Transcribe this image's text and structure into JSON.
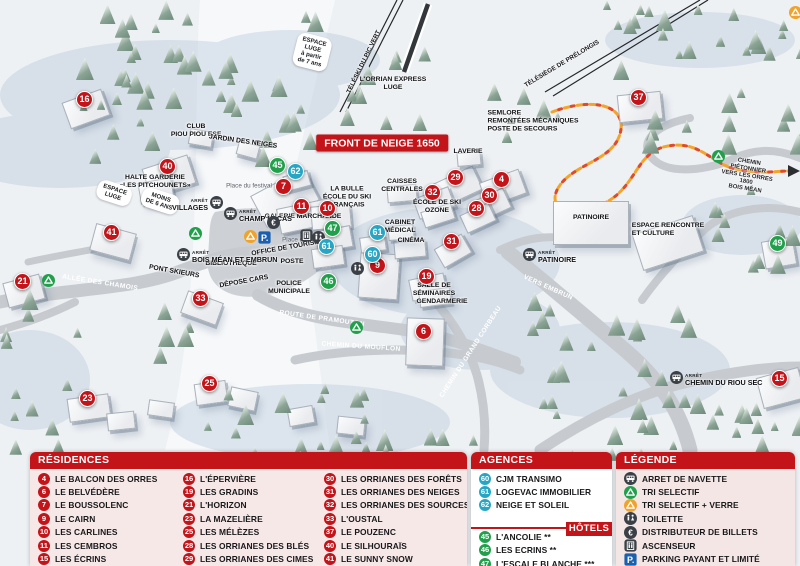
{
  "colors": {
    "red": "#c3141a",
    "teal": "#27a5c5",
    "green": "#21a04c",
    "orange": "#f0a22a",
    "busdark": "#3a4046",
    "parkblue": "#1b5fae",
    "panelpink": "#f7e8e8"
  },
  "map": {
    "bus_stop_word": "ARRÊT",
    "labels": [
      {
        "t": "FRONT DE NEIGE 1650",
        "cls": "banner",
        "x": 382,
        "y": 143
      },
      {
        "t": "ESPACE\nLUGE\nà partir\nde 7 ans",
        "cls": "pill",
        "x": 312,
        "y": 52,
        "rot": 14
      },
      {
        "t": "TÉLÉSKI DU PIC VERT",
        "cls": "lift",
        "x": 364,
        "y": 62,
        "rot": -64
      },
      {
        "t": "L'ORRIAN EXPRESS\nLUGE",
        "cls": "place",
        "x": 393,
        "y": 84
      },
      {
        "t": "TÉLÉSIÈGE DE PRÉLONGIS",
        "cls": "lift",
        "x": 562,
        "y": 64,
        "rot": -31
      },
      {
        "t": "SEMLORE\nREMONTÉES MÉCANIQUES\nPOSTE DE SECOURS",
        "cls": "place-left",
        "x": 533,
        "y": 121
      },
      {
        "t": "CLUB\nPIOU PIOU ESF",
        "cls": "place",
        "x": 196,
        "y": 131
      },
      {
        "t": "JARDIN DES NEIGES",
        "cls": "place",
        "x": 243,
        "y": 142,
        "rot": 8
      },
      {
        "t": "HALTE GARDERIE\n«LES PITCHOUNETS»",
        "cls": "place",
        "x": 155,
        "y": 182
      },
      {
        "t": "ESPACE\nLUGE",
        "cls": "pill",
        "x": 114,
        "y": 193,
        "rot": 18
      },
      {
        "t": "MOINS\nDE 6 ANS",
        "cls": "pill",
        "x": 160,
        "y": 201,
        "rot": 18
      },
      {
        "t": "Place du festival",
        "cls": "minor",
        "x": 249,
        "y": 186
      },
      {
        "t": "LA BULLE\nÉCOLE DU SKI\nFRANÇAIS",
        "cls": "place",
        "x": 347,
        "y": 197
      },
      {
        "t": "GALERIE MARCHANDE",
        "cls": "place",
        "x": 303,
        "y": 217
      },
      {
        "t": "CAISSES\nCENTRALES",
        "cls": "place",
        "x": 402,
        "y": 186
      },
      {
        "t": "ÉCOLE DE SKI\nOZONE",
        "cls": "place",
        "x": 437,
        "y": 207
      },
      {
        "t": "CABINET\nMÉDICAL",
        "cls": "place",
        "x": 400,
        "y": 227
      },
      {
        "t": "CINÉMA",
        "cls": "place",
        "x": 411,
        "y": 241
      },
      {
        "t": "OFFICE DE TOURISME",
        "cls": "place",
        "x": 288,
        "y": 248,
        "rot": -10
      },
      {
        "t": "BIBLIOTHÈQUE",
        "cls": "place",
        "x": 231,
        "y": 264
      },
      {
        "t": "POSTE",
        "cls": "place",
        "x": 292,
        "y": 262
      },
      {
        "t": "DÉPOSE CARS",
        "cls": "place",
        "x": 244,
        "y": 282,
        "rot": -10
      },
      {
        "t": "POLICE\nMUNICIPALE",
        "cls": "place",
        "x": 289,
        "y": 288
      },
      {
        "t": "Place d'accueil",
        "cls": "minor",
        "x": 303,
        "y": 240
      },
      {
        "t": "SALLE DE\nSÉMINAIRES",
        "cls": "place",
        "x": 434,
        "y": 290
      },
      {
        "t": "GENDARMERIE",
        "cls": "place",
        "x": 442,
        "y": 302
      },
      {
        "t": "LAVERIE",
        "cls": "place",
        "x": 468,
        "y": 152
      },
      {
        "t": "PATINOIRE",
        "cls": "place",
        "x": 591,
        "y": 218
      },
      {
        "t": "ESPACE RENCONTRE\nET CULTURE",
        "cls": "place-left",
        "x": 668,
        "y": 230
      },
      {
        "t": "CHEMIN PIÉTONNIER\nVERS LES ORRES 1800\nBOIS MÉAN",
        "cls": "tiny",
        "x": 747,
        "y": 176,
        "rot": 9
      },
      {
        "t": "ALLÉE DES CHAMOIS",
        "cls": "road",
        "x": 100,
        "y": 283,
        "rot": 9
      },
      {
        "t": "PONT SKIEURS",
        "cls": "place",
        "x": 174,
        "y": 272,
        "rot": 10
      },
      {
        "t": "ROUTE DE PRAMOUTON",
        "cls": "road",
        "x": 322,
        "y": 319,
        "rot": 8
      },
      {
        "t": "CHEMIN DU MOUFLON",
        "cls": "road",
        "x": 361,
        "y": 347,
        "rot": 4
      },
      {
        "t": "CHEMIN DU GRAND CORBEAU",
        "cls": "road",
        "x": 471,
        "y": 352,
        "rot": -57
      },
      {
        "t": "VERS EMBRUN",
        "cls": "road",
        "x": 548,
        "y": 288,
        "rot": 24
      }
    ],
    "bus_stops": [
      {
        "name": "VILLAGES",
        "x": 216,
        "y": 205,
        "side": "left"
      },
      {
        "name": "CHAMP LACAS",
        "x": 231,
        "y": 216,
        "side": "right"
      },
      {
        "name": "BOIS MÉAN ET EMBRUN",
        "x": 184,
        "y": 257,
        "side": "right"
      },
      {
        "name": "PATINOIRE",
        "x": 530,
        "y": 257,
        "side": "right"
      },
      {
        "name": "CHEMIN DU RIOU SEC",
        "x": 677,
        "y": 380,
        "side": "right"
      }
    ],
    "markers": [
      {
        "n": 16,
        "type": "red",
        "x": 85,
        "y": 100
      },
      {
        "n": 40,
        "type": "red",
        "x": 168,
        "y": 167
      },
      {
        "n": 41,
        "type": "red",
        "x": 112,
        "y": 233
      },
      {
        "n": 21,
        "type": "red",
        "x": 23,
        "y": 282
      },
      {
        "n": 33,
        "type": "red",
        "x": 201,
        "y": 299
      },
      {
        "n": 23,
        "type": "red",
        "x": 88,
        "y": 399
      },
      {
        "n": 25,
        "type": "red",
        "x": 210,
        "y": 384
      },
      {
        "n": 7,
        "type": "red",
        "x": 284,
        "y": 187
      },
      {
        "n": 11,
        "type": "red",
        "x": 302,
        "y": 207
      },
      {
        "n": 10,
        "type": "red",
        "x": 328,
        "y": 209
      },
      {
        "n": 9,
        "type": "red",
        "x": 378,
        "y": 266
      },
      {
        "n": 19,
        "type": "red",
        "x": 427,
        "y": 277
      },
      {
        "n": 6,
        "type": "red",
        "x": 424,
        "y": 332
      },
      {
        "n": 29,
        "type": "red",
        "x": 456,
        "y": 178
      },
      {
        "n": 32,
        "type": "red",
        "x": 433,
        "y": 193
      },
      {
        "n": 31,
        "type": "red",
        "x": 452,
        "y": 242
      },
      {
        "n": 4,
        "type": "red",
        "x": 502,
        "y": 180
      },
      {
        "n": 30,
        "type": "red",
        "x": 490,
        "y": 196
      },
      {
        "n": 28,
        "type": "red",
        "x": 477,
        "y": 209
      },
      {
        "n": 37,
        "type": "red",
        "x": 639,
        "y": 98
      },
      {
        "n": 15,
        "type": "red",
        "x": 780,
        "y": 379
      },
      {
        "n": 62,
        "type": "teal",
        "x": 296,
        "y": 172
      },
      {
        "n": 61,
        "type": "teal",
        "x": 327,
        "y": 247
      },
      {
        "n": 61,
        "type": "teal",
        "x": 378,
        "y": 233
      },
      {
        "n": 60,
        "type": "teal",
        "x": 373,
        "y": 255
      },
      {
        "n": 45,
        "type": "green",
        "x": 278,
        "y": 166
      },
      {
        "n": 47,
        "type": "green",
        "x": 333,
        "y": 229
      },
      {
        "n": 46,
        "type": "green",
        "x": 329,
        "y": 282
      },
      {
        "n": 49,
        "type": "green",
        "x": 778,
        "y": 244
      }
    ],
    "icons": [
      {
        "icon": "euro",
        "x": 273,
        "y": 222
      },
      {
        "icon": "parking",
        "x": 264,
        "y": 237
      },
      {
        "icon": "recycleO",
        "x": 250,
        "y": 236
      },
      {
        "icon": "elevator",
        "x": 306,
        "y": 235
      },
      {
        "icon": "wc",
        "x": 318,
        "y": 237
      },
      {
        "icon": "wc",
        "x": 357,
        "y": 268
      },
      {
        "icon": "recycleG",
        "x": 195,
        "y": 233
      },
      {
        "icon": "recycleG",
        "x": 48,
        "y": 280
      },
      {
        "icon": "recycleG",
        "x": 718,
        "y": 156
      },
      {
        "icon": "recycleG",
        "x": 356,
        "y": 327
      },
      {
        "icon": "recycleO",
        "x": 795,
        "y": 12
      }
    ]
  },
  "panels": {
    "residences": {
      "title": "RÉSIDENCES",
      "items": [
        {
          "n": 4,
          "name": "LE BALCON DES ORRES"
        },
        {
          "n": 6,
          "name": "LE BELVÉDÈRE"
        },
        {
          "n": 7,
          "name": "LE BOUSSOLENC"
        },
        {
          "n": 9,
          "name": "LE CAIRN"
        },
        {
          "n": 10,
          "name": "LES CARLINES"
        },
        {
          "n": 11,
          "name": "LES CEMBROS"
        },
        {
          "n": 15,
          "name": "LES ÉCRINS"
        },
        {
          "n": 16,
          "name": "L'ÉPERVIÈRE"
        },
        {
          "n": 19,
          "name": "LES GRADINS"
        },
        {
          "n": 21,
          "name": "L'HORIZON"
        },
        {
          "n": 23,
          "name": "LA MAZELIÈRE"
        },
        {
          "n": 25,
          "name": "LES MÉLÈZES"
        },
        {
          "n": 28,
          "name": "LES ORRIANES DES BLÉS"
        },
        {
          "n": 29,
          "name": "LES ORRIANES DES CIMES"
        },
        {
          "n": 30,
          "name": "LES ORRIANES DES FORÊTS"
        },
        {
          "n": 31,
          "name": "LES ORRIANES DES NEIGES"
        },
        {
          "n": 32,
          "name": "LES ORRIANES DES SOURCES"
        },
        {
          "n": 33,
          "name": "L'OUSTAL"
        },
        {
          "n": 37,
          "name": "LE POUZENC"
        },
        {
          "n": 40,
          "name": "LE SILHOURAÏS"
        },
        {
          "n": 41,
          "name": "LE SUNNY SNOW"
        }
      ]
    },
    "agences": {
      "title": "AGENCES IMMOBILIÈRES",
      "items": [
        {
          "n": 60,
          "name": "CJM TRANSIMO"
        },
        {
          "n": 61,
          "name": "LOGEVAC IMMOBILIER"
        },
        {
          "n": 62,
          "name": "NEIGE ET SOLEIL"
        }
      ]
    },
    "hotels": {
      "title": "HÔTELS",
      "items": [
        {
          "n": 45,
          "name": "L'ANCOLIE **"
        },
        {
          "n": 46,
          "name": "LES ECRINS **"
        },
        {
          "n": 47,
          "name": "L'ESCALE BLANCHE ***"
        },
        {
          "n": 49,
          "name": "LES TRAPPEURS **"
        }
      ]
    },
    "legende": {
      "title": "LÉGENDE",
      "items": [
        {
          "icon": "bus",
          "label": "ARRET DE NAVETTE"
        },
        {
          "icon": "recycleG",
          "label": "TRI SELECTIF"
        },
        {
          "icon": "recycleO",
          "label": "TRI SELECTIF + VERRE"
        },
        {
          "icon": "wc",
          "label": "TOILETTE"
        },
        {
          "icon": "euro",
          "label": "DISTRIBUTEUR DE BILLETS"
        },
        {
          "icon": "elevator",
          "label": "ASCENSEUR"
        },
        {
          "icon": "parking",
          "label": "PARKING PAYANT ET LIMITÉ"
        }
      ]
    }
  }
}
